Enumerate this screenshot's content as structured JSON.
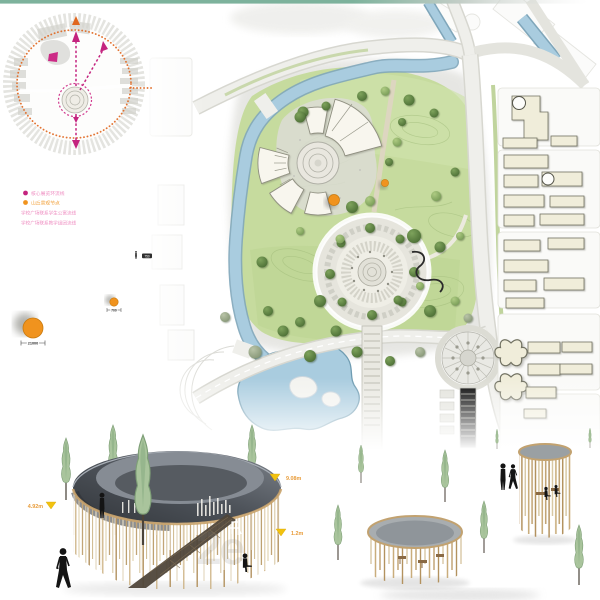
{
  "legend": {
    "items": [
      {
        "label": "核心展览环流线",
        "dot": "#c4247f",
        "text": "#ef8fc2"
      },
      {
        "label": "山丘景观节点",
        "dot": "#f0931e",
        "text": "#f2a23c"
      },
      {
        "label": "学校广场联系学生公寓流线",
        "dot": "",
        "text": "#ef8fc2"
      },
      {
        "label": "学校广场联系教学组团流线",
        "dot": "",
        "text": "#ef8fc2"
      }
    ]
  },
  "scale_notes": {
    "large_dim": "21000",
    "small_dim": "700",
    "tag": "750"
  },
  "elevation_markers": {
    "left": "4.92m",
    "right_top": "9.08m",
    "right_bottom": "1.2m"
  },
  "watermark": "2e",
  "palette": {
    "accent_orange": "#f0931e",
    "accent_magenta": "#c4247f",
    "marker_yellow": "#f2c20f",
    "park_green": "#c3d89b",
    "water_blue": "#a9ccdf",
    "ribbon_gray": "#4a4f55",
    "wood_tan": "#c2a577",
    "top_bar_green": "#7db29c"
  }
}
